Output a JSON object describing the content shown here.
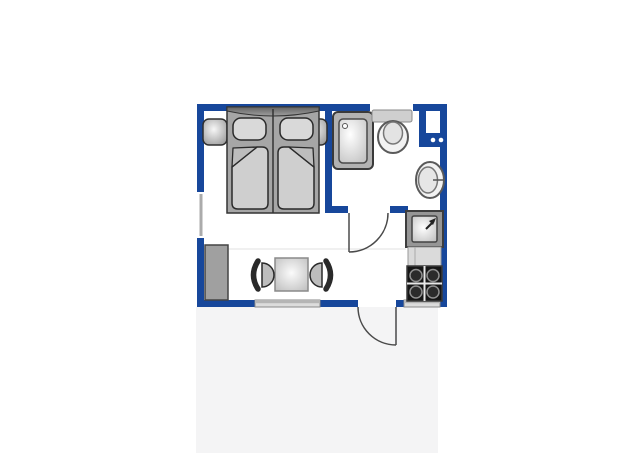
{
  "title": "studio-apartment-floor-plan",
  "colors": {
    "wall": "#17479b",
    "panel": "#f4f4f5",
    "door_line": "#4a4a4a",
    "outline": "#333333",
    "furniture_mid": "#a6a6a6",
    "furniture_light": "#d9d9d9",
    "stove_black": "#161616"
  },
  "floor_plan": {
    "rooms": [
      {
        "name": "bedroom",
        "position": "top-left"
      },
      {
        "name": "bathroom",
        "position": "top-right"
      },
      {
        "name": "kitchenette",
        "position": "right"
      },
      {
        "name": "living-dining-area",
        "position": "bottom"
      }
    ],
    "furniture": [
      "double-bed-with-two-mattresses",
      "nightstand-left",
      "nightstand-right",
      "shower",
      "toilet",
      "cistern-shelf",
      "wash-basin",
      "kitchen-sink",
      "kitchen-counter",
      "stove-four-burners",
      "wardrobe",
      "dining-table",
      "chair-left",
      "chair-right",
      "utility-niche-two-dots"
    ],
    "openings": [
      "window-left-wall",
      "window-bathroom-top-wall",
      "window-living-bottom-wall",
      "window-kitchen-bottom-wall",
      "interior-door-bathroom",
      "entrance-door-bottom"
    ]
  }
}
